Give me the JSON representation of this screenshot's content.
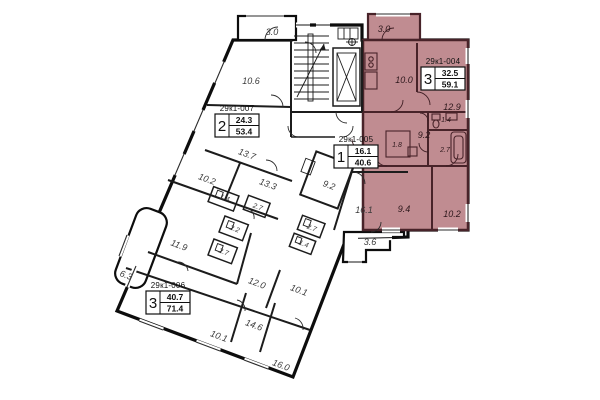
{
  "plan": {
    "highlighted_apartment_id": "29к1-004",
    "colors": {
      "highlight_fill": "#c08c91",
      "highlight_wall": "#482329",
      "wall": "#111111",
      "background": "#ffffff"
    },
    "apartments": [
      {
        "id": "29к1-007",
        "room_count": "2",
        "living_area": "24.3",
        "total_area": "53.4",
        "highlighted": false
      },
      {
        "id": "29к1-004",
        "room_count": "3",
        "living_area": "32.5",
        "total_area": "59.1",
        "highlighted": true
      },
      {
        "id": "29к1-005",
        "room_count": "1",
        "living_area": "16.1",
        "total_area": "40.6",
        "highlighted": false
      },
      {
        "id": "29к1-006",
        "room_count": "3",
        "living_area": "40.7",
        "total_area": "71.4",
        "highlighted": false
      }
    ],
    "room_areas": [
      {
        "v": "3.0"
      },
      {
        "v": "10.6"
      },
      {
        "v": "13.7"
      },
      {
        "v": "10.2"
      },
      {
        "v": "13.3"
      },
      {
        "v": "1.4"
      },
      {
        "v": "2.7"
      },
      {
        "v": "2.2"
      },
      {
        "v": "2.7"
      },
      {
        "v": "11.9"
      },
      {
        "v": "6.3"
      },
      {
        "v": "12.0"
      },
      {
        "v": "10.1"
      },
      {
        "v": "14.6"
      },
      {
        "v": "10.1"
      },
      {
        "v": "16.0"
      },
      {
        "v": "9.2"
      },
      {
        "v": "2.7"
      },
      {
        "v": "1.4"
      },
      {
        "v": "16.1"
      },
      {
        "v": "3.6"
      },
      {
        "v": "3.0"
      },
      {
        "v": "10.0"
      },
      {
        "v": "12.9"
      },
      {
        "v": "1.4"
      },
      {
        "v": "9.2"
      },
      {
        "v": "1.8"
      },
      {
        "v": "2.7"
      },
      {
        "v": "9.4"
      },
      {
        "v": "10.2"
      }
    ]
  }
}
